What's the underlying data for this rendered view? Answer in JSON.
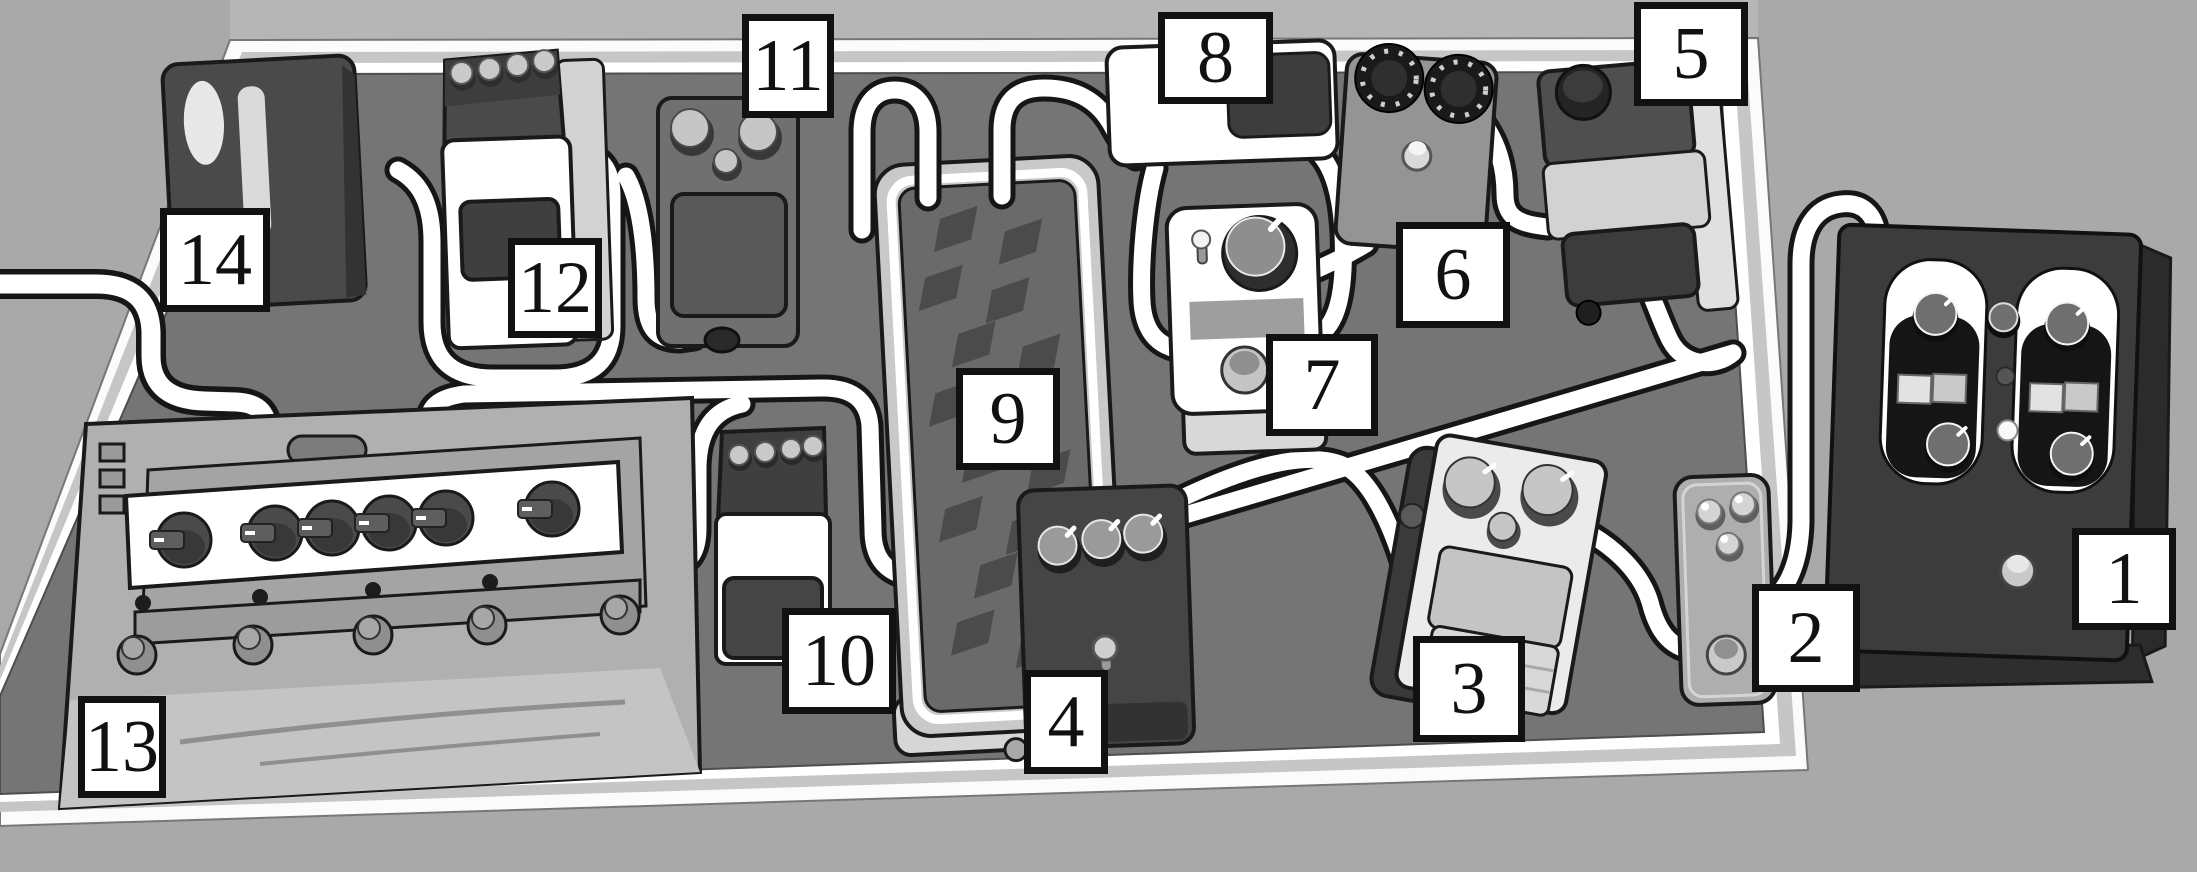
{
  "diagram": {
    "title": "pedalboard-wiring-illustration",
    "palette": {
      "background": "#a9a9a9",
      "wall_band": "#b6b6b6",
      "board_surface": "#757575",
      "board_frame": "#c6c6c6",
      "board_edge_line": "#ffffff",
      "cable_core": "#ffffff",
      "cable_outline": "#161616",
      "pedal_dark": "#454545",
      "pedal_white": "#ffffff",
      "callout_background": "#ffffff",
      "callout_border": "#111111"
    }
  },
  "callouts": [
    {
      "text": "1",
      "target": "dual-footswitch-pedal"
    },
    {
      "text": "2",
      "target": "mini-pedal"
    },
    {
      "text": "3",
      "target": "compact-overdrive-pedal"
    },
    {
      "text": "4",
      "target": "three-knob-dark-pedal"
    },
    {
      "text": "5",
      "target": "compact-pedal-top-right"
    },
    {
      "text": "6",
      "target": "two-knob-gray-pedal"
    },
    {
      "text": "7",
      "target": "one-knob-white-pedal"
    },
    {
      "text": "8",
      "target": "flat-white-pedal"
    },
    {
      "text": "9",
      "target": "expression-treadle-pedal"
    },
    {
      "text": "10",
      "target": "four-knob-compact-pedal"
    },
    {
      "text": "11",
      "target": "three-knob-compact-pedal"
    },
    {
      "text": "12",
      "target": "four-knob-white-compact-pedal"
    },
    {
      "text": "13",
      "target": "six-knob-multi-effects-unit"
    },
    {
      "text": "14",
      "target": "utility-box"
    }
  ]
}
